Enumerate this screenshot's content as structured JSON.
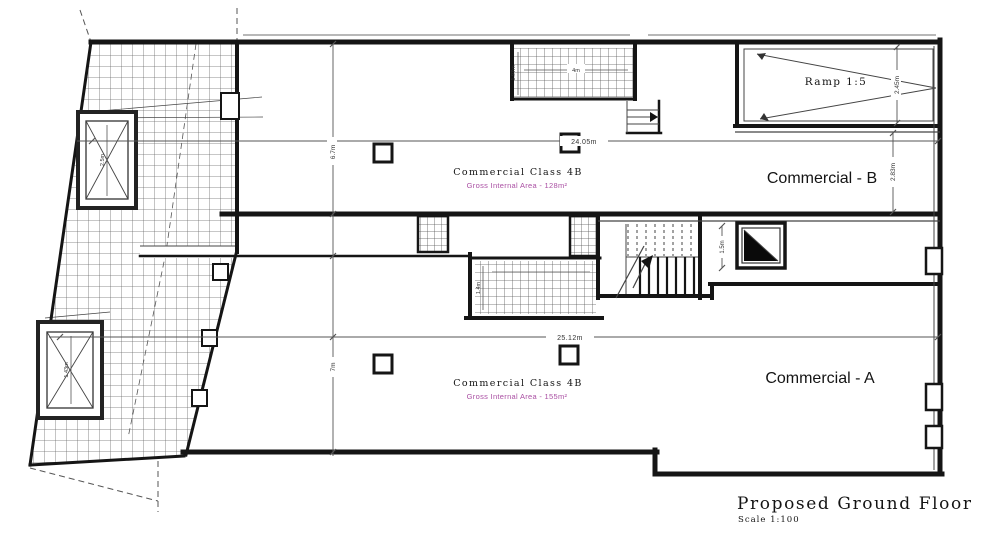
{
  "drawing": {
    "title": "Proposed Ground Floor",
    "scale": "Scale 1:100"
  },
  "labels": {
    "ramp": "Ramp 1:5",
    "unit_b": {
      "name": "Commercial - B",
      "use_class": "Commercial Class 4B",
      "area": "Gross Internal Area - 128m²"
    },
    "unit_a": {
      "name": "Commercial - A",
      "use_class": "Commercial Class 4B",
      "area": "Gross Internal Area - 155m²"
    }
  },
  "dimensions": {
    "unit_b_width": "24.05m",
    "unit_a_width": "25.12m",
    "unit_b_depth": "6.7m",
    "unit_a_depth": "7m",
    "ramp_width": "2.45m",
    "unit_b_right_depth": "2.83m",
    "lift_lobby_width": "1.5m",
    "lift_left_upper": "2.5m",
    "lift_left_lower": "1.43m",
    "top_block_width": "4m",
    "top_block_depth": "1.97m",
    "entrance_depth": "1.4m"
  },
  "colors": {
    "area_text": "#aa4fa3",
    "wall": "#151515"
  }
}
